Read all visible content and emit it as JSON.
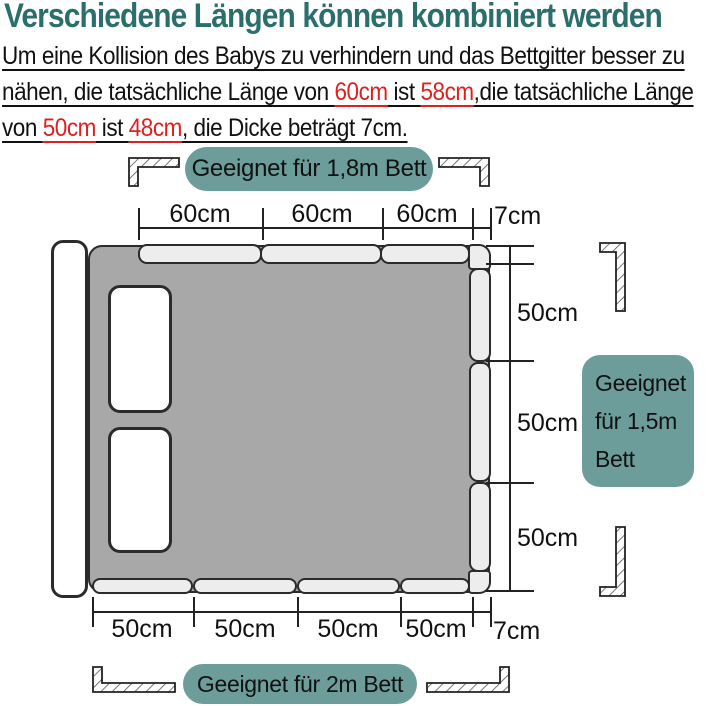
{
  "title": "Verschiedene Längen können kombiniert werden",
  "intro": {
    "line1": "Um eine Kollision des Babys zu verhindern und das Bettgitter besser zu",
    "line2": {
      "a": "nähen, die tatsächliche Länge von ",
      "b": "60cm",
      "c": " ist ",
      "d": "58cm",
      "e": ",die tatsächliche Länge"
    },
    "line3": {
      "a": "von ",
      "b": "50cm",
      "c": " ist ",
      "d": "48cm",
      "e": ", die Dicke beträgt 7cm."
    }
  },
  "badges": {
    "top": "Geeignet für 1,8m Bett",
    "right_line1": "Geeignet",
    "right_line2": "für 1,5m",
    "right_line3": "Bett",
    "bottom": "Geeignet für 2m Bett"
  },
  "dimensions": {
    "top": {
      "segments": [
        "60cm",
        "60cm",
        "60cm"
      ],
      "thickness": "7cm"
    },
    "right": {
      "segments": [
        "50cm",
        "50cm",
        "50cm"
      ]
    },
    "bottom": {
      "segments": [
        "50cm",
        "50cm",
        "50cm",
        "50cm"
      ],
      "thickness": "7cm"
    }
  },
  "icons": {
    "rail_profile": "rail-cross-section-icon"
  },
  "colors": {
    "title_teal": "#2b6f6c",
    "badge_teal": "#6d9d9b",
    "highlight_red": "#e01f1f",
    "mattress_gray": "#a8a8a8",
    "rail_gray": "#ededed",
    "line_dark": "#222222"
  }
}
